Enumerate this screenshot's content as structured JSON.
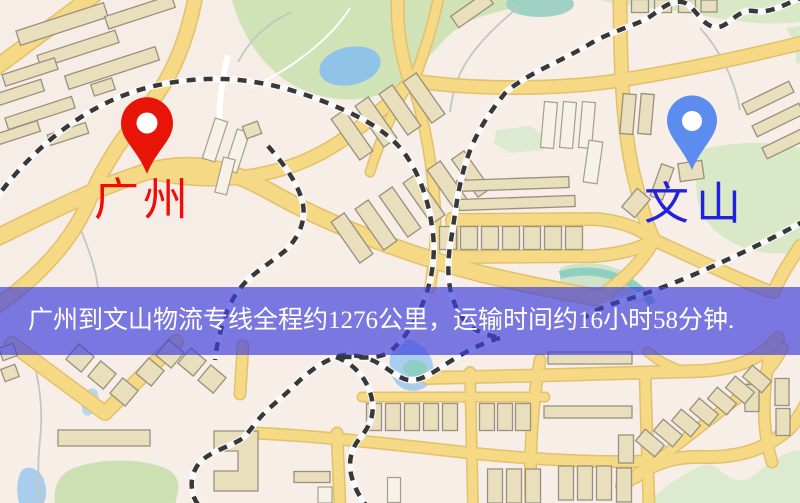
{
  "map": {
    "markers": {
      "origin": {
        "label": "广州",
        "label_color": "#f40b06",
        "pin_color": "#e81408"
      },
      "destination": {
        "label": "文山",
        "label_color": "#2222dd",
        "pin_color": "#5b8cee"
      }
    },
    "banner": {
      "text": "广州到文山物流专线全程约1276公里，运输时间约16小时58分钟.",
      "background": "#4040dd",
      "text_color": "#ffffff"
    },
    "route": {
      "origin": "广州",
      "destination": "文山",
      "distance_km": "1276",
      "duration_text": "16小时58分钟"
    },
    "palette": {
      "background": "#f6eee7",
      "road": "#f5d985",
      "road_casing": "#e3c06c",
      "park": "#cfe3b7",
      "water": "#8fc3e8",
      "railway": "#383838",
      "building": "#eadfbd"
    }
  }
}
